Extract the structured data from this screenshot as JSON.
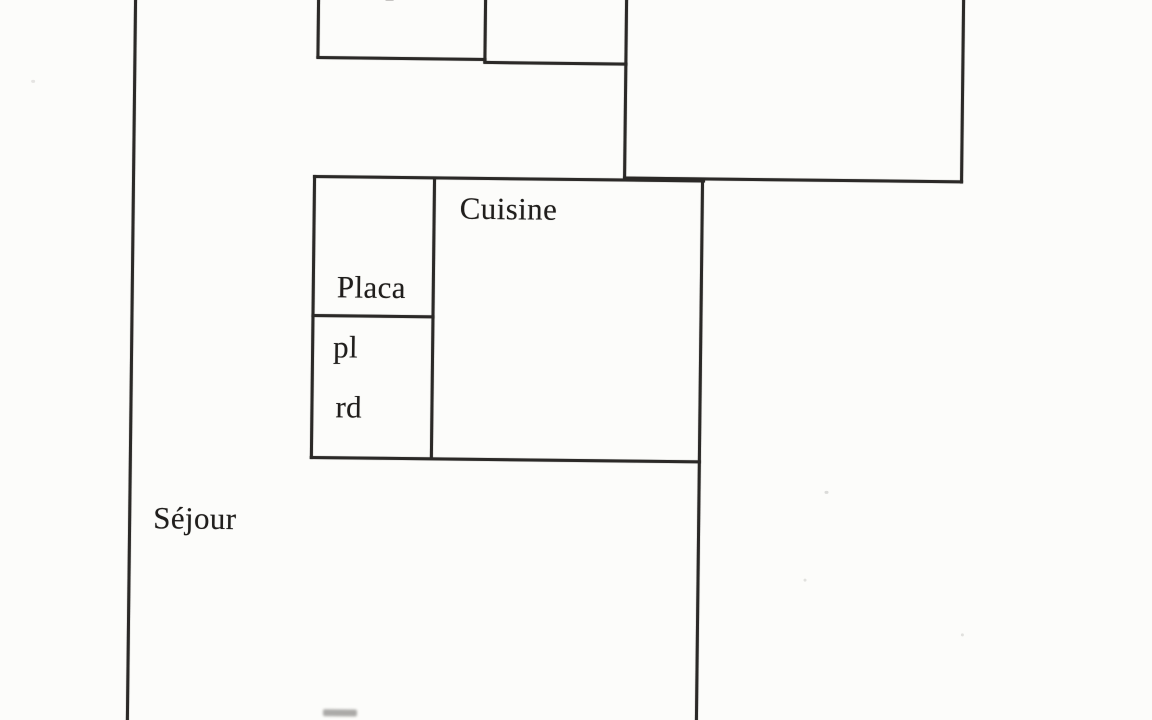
{
  "plan": {
    "title": "apartment-floor-plan-scan",
    "rooms": {
      "placard": {
        "label": "Placard",
        "display_lines": [
          "Placa",
          "rd"
        ]
      },
      "pl_closet": {
        "label": "pl"
      },
      "cuisine": {
        "label": "Cuisine"
      },
      "sejour": {
        "label": "Séjour"
      }
    },
    "colors": {
      "wall": "#2b2927",
      "paper": "#fcfcfa",
      "ink": "#201e1c"
    }
  }
}
